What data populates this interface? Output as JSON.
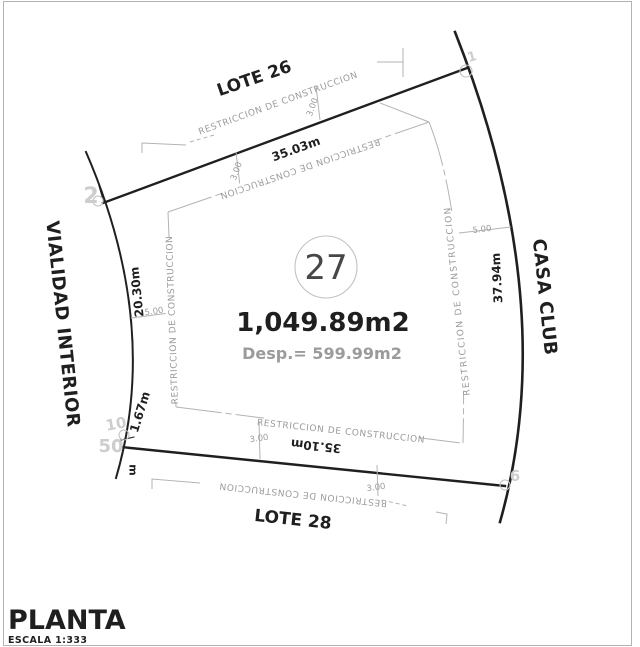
{
  "colors": {
    "ink": "#1f1f1f",
    "muted": "#9b9b9b",
    "faint": "#b3b3b3",
    "ghost": "#cdcdcd",
    "paper": "#ffffff"
  },
  "plan": {
    "lot_number": "27",
    "area": "1,049.89m2",
    "displacement": "Desp.= 599.99m2",
    "neighbor_top": "LOTE 26",
    "neighbor_bottom": "LOTE 28",
    "street_left": "VIALIDAD INTERIOR",
    "facility_right": "CASA CLUB",
    "setback_label": "RESTRICCION DE CONSTRUCCION",
    "dim_top": "35.03m",
    "dim_bottom": "35.10m",
    "dim_left": "20.30m",
    "dim_left_short": "1.67m",
    "dim_right": "37.94m",
    "setback_side": "5.00",
    "setback_front": "3.00",
    "unit_mark": "m",
    "vertex_1": "1",
    "vertex_2": "2",
    "vertex_10": "10",
    "vertex_50": "50",
    "vertex_6": "6"
  },
  "title_block": {
    "title": "PLANTA",
    "scale": "ESCALA 1:333"
  }
}
